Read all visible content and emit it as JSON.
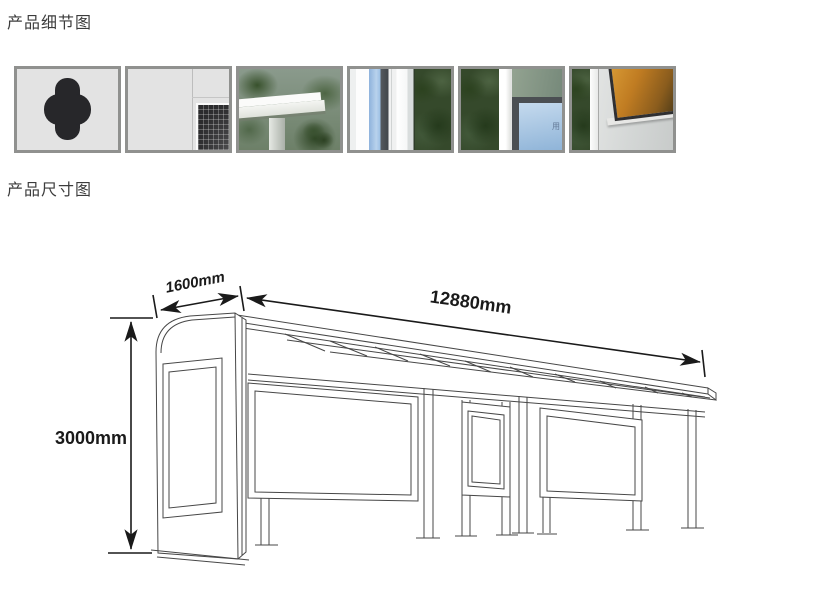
{
  "sections": {
    "details_title": "产品细节图",
    "dimensions_title": "产品尺寸图"
  },
  "thumbnails": {
    "items": [
      {
        "name": "panel-cutout-hole"
      },
      {
        "name": "panel-corner-mesh"
      },
      {
        "name": "roof-corner"
      },
      {
        "name": "pillar-and-lightbox-edge"
      },
      {
        "name": "frame-corner-sky-poster",
        "overlay_text": "用"
      },
      {
        "name": "amber-glass-window"
      }
    ]
  },
  "diagram": {
    "depth_label": "1600mm",
    "width_label": "12880mm",
    "height_label": "3000mm"
  },
  "colors": {
    "title_text": "#3c3c3c",
    "thumbnail_border": "#90918f",
    "line_art": "#474747",
    "dimension_ink": "#1a1a1a"
  }
}
